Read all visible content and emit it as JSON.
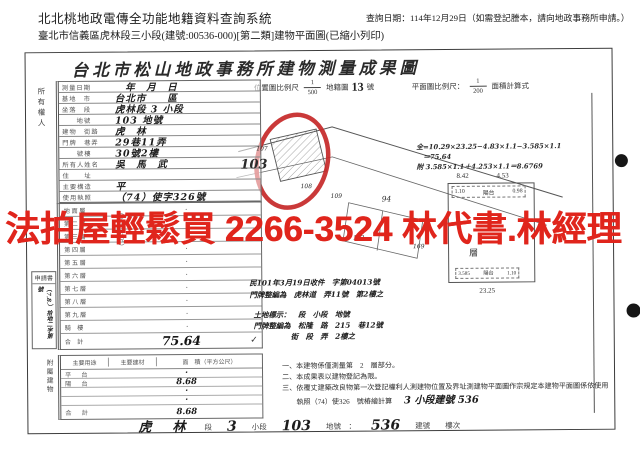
{
  "header": {
    "system_title": "北北桃地政電傳全功能地籍資料查詢系統",
    "query_date": "查詢日期：114年12月29日（如需登記謄本，請向地政事務所申請。）",
    "subtitle": "臺北市信義區虎林段三小段(建號:00536-000)[第二類]建物平面圖(已縮小列印)"
  },
  "doc": {
    "title": "台北市松山地政事務所建物測量成果圖",
    "watermark": "法拍屋輕鬆買 2266-3524 林代書.林經理",
    "owner_col": "所有權人",
    "scales": {
      "loc_label": "位置圖比例尺",
      "loc_num": "1",
      "loc_den": "500",
      "map_label": "地籍圖",
      "map_no": "13",
      "map_unit": "號",
      "plan_label": "平面圖比例尺：",
      "plan_num": "1",
      "plan_den": "200",
      "area_label": "面積計算式"
    },
    "form_rows": [
      {
        "label": "測量日期",
        "value": "　年　月　日"
      },
      {
        "label": "基地　市",
        "value": "台北市　　區"
      },
      {
        "label": "坐落　段",
        "value": "虎林段 3 小段"
      },
      {
        "label": "　　地號",
        "value": "103 地號"
      },
      {
        "label": "建物　街路",
        "value": "虎　林"
      },
      {
        "label": "門牌　巷弄",
        "value": "29巷11弄"
      },
      {
        "label": "　　號樓",
        "value": "30號2樓"
      },
      {
        "label": "所有人姓名",
        "value": "吳　馬　武"
      },
      {
        "label": "住　　址",
        "value": "　"
      },
      {
        "label": "主要構造",
        "value": "平"
      },
      {
        "label": "使用執照",
        "value": "（74）使字326號"
      }
    ],
    "floors": {
      "unit": "（平方公尺）",
      "rows": [
        {
          "label": "地 面 層",
          "value": "·"
        },
        {
          "label": "第 二 層",
          "value": "·"
        },
        {
          "label": "第 三 層",
          "value": "·"
        },
        {
          "label": "第 四 層",
          "value": "·"
        },
        {
          "label": "第 五 層",
          "value": "·"
        },
        {
          "label": "第 六 層",
          "value": "·"
        },
        {
          "label": "第 七 層",
          "value": "·"
        },
        {
          "label": "第 八 層",
          "value": "·"
        },
        {
          "label": "第 九 層",
          "value": "·"
        },
        {
          "label": "騎　樓",
          "value": "·"
        }
      ],
      "total_label": "合　計",
      "total": "75.64",
      "check": "✓"
    },
    "apply_box": {
      "title": "申請書",
      "no": "（7.8.）拾地二字第　號"
    },
    "annex": {
      "side": "附屬建物",
      "h1": "主要用途",
      "h2": "主要建材",
      "h3": "面　積（平方公尺）",
      "rows": [
        {
          "label": "平　台",
          "value": "·"
        },
        {
          "label": "陽　台",
          "value": "8.68"
        },
        {
          "label": "",
          "value": "·"
        },
        {
          "label": "",
          "value": "·"
        }
      ],
      "total_label": "合　計",
      "total": "8.68"
    },
    "calc": {
      "c1": "全=10.29×23.25−4.83×1.1−3.585×1.1",
      "c2": "　＝75.64",
      "c3": "附 3.585×1.1＋4.253×1.1＝8.6769"
    },
    "plan": {
      "d_top1": "8.42",
      "d_top2": "4.53",
      "d_left": "1.10",
      "balcony": "陽台",
      "d_right": "0.98",
      "room": "層",
      "d_b1": "3.585",
      "d_b2": "陽台",
      "d_b3": "1.10",
      "d_bottom": "23.25"
    },
    "hw_notes": {
      "a1": "民101年3月19日收件　字第04013號",
      "a2": "門牌整編為　虎林道　弄11號　第2樓之",
      "b1": "土地標示：　段　小段　地號",
      "b2": "門牌整編為　松隆　路　215　巷12號",
      "b3": "　　　　　街　段　弄　2樓之"
    },
    "notes": {
      "n1": "一、本建物係僅測量第　2　層部分。",
      "n2": "二、本成果表以建物登記為限。",
      "n3": "三、依覆丈建築改良物第一次登記權利人測建物位置及界址測建物平面圖作宗規定本建物平面圖係依使用",
      "n4": "　　執照（74）使326　號樁繪計算",
      "n4_hw": "3 小段建號 536"
    },
    "sketch": {
      "l103": "103",
      "l107": "107",
      "l108": "108",
      "l109": "109",
      "l94": "94",
      "l163": "163",
      "l169": "169"
    },
    "footer": {
      "seg_hw": "虎　林",
      "seg": "段",
      "sub_hw": "3",
      "sub": "小段",
      "lot_hw": "103",
      "lot": "地號　：",
      "bno_hw": "536",
      "bno": "建號",
      "floor": "樓次"
    },
    "colors": {
      "watermark_red": "#e0251c",
      "circle_red": "#c62828",
      "ink": "#2e2e2e"
    }
  }
}
